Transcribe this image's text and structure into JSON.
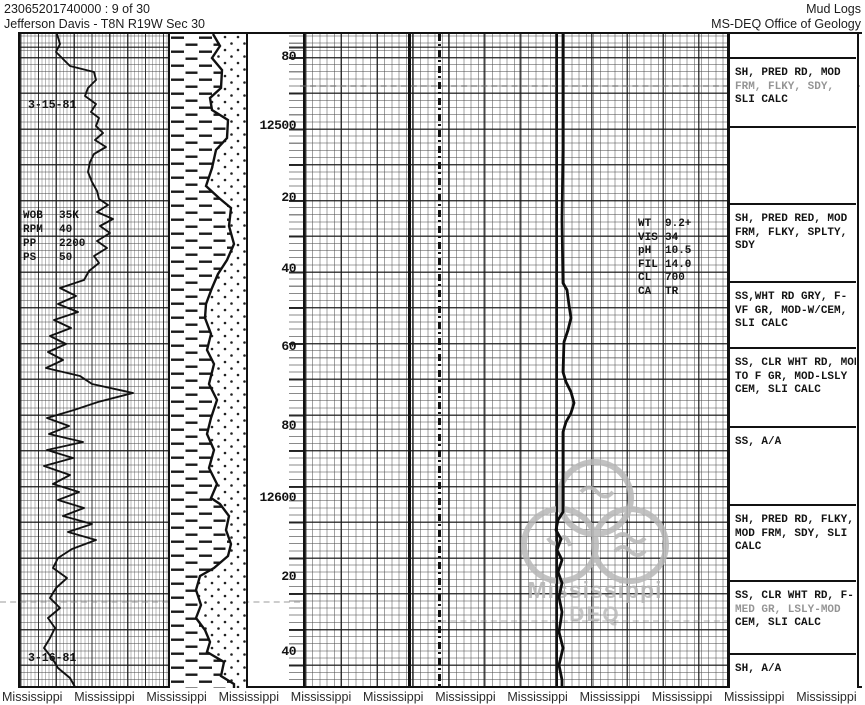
{
  "header": {
    "left_line1": "23065201740000 : 9 of 30",
    "left_line2": "Jefferson Davis - T8N R19W Sec 30",
    "right_line1": "Mud Logs",
    "right_line2": "MS-DEQ Office of Geology"
  },
  "log": {
    "dates": [
      {
        "text": "3-15-81"
      },
      {
        "text": "3-16-81"
      }
    ],
    "drill_params": {
      "rows": [
        [
          "WOB",
          "35K"
        ],
        [
          "RPM",
          "40"
        ],
        [
          "PP",
          "2200"
        ],
        [
          "PS",
          "50"
        ]
      ]
    },
    "mud_data": {
      "rows": [
        [
          "WT",
          "9.2+"
        ],
        [
          "VIS",
          "34"
        ],
        [
          "pH",
          "10.5"
        ],
        [
          "FIL",
          "14.0"
        ],
        [
          "CL",
          "700"
        ],
        [
          "CA",
          "TR"
        ]
      ]
    },
    "depth_labels": [
      {
        "text": "80",
        "y": 57
      },
      {
        "text": "12500",
        "y": 126
      },
      {
        "text": "20",
        "y": 198
      },
      {
        "text": "40",
        "y": 269
      },
      {
        "text": "60",
        "y": 347
      },
      {
        "text": "80",
        "y": 426
      },
      {
        "text": "12600",
        "y": 498
      },
      {
        "text": "20",
        "y": 577
      },
      {
        "text": "40",
        "y": 652
      }
    ],
    "desc_bottom": 688,
    "descriptions": [
      {
        "top": 34,
        "lines": []
      },
      {
        "top": 57,
        "lines": [
          "SH, PRED RD, MOD",
          "FRM, FLKY, SDY,",
          "SLI CALC"
        ],
        "faded_line": 1
      },
      {
        "top": 126,
        "lines": []
      },
      {
        "top": 203,
        "lines": [
          "SH, PRED RED, MOD",
          "FRM, FLKY, SPLTY,",
          "SDY"
        ]
      },
      {
        "top": 281,
        "lines": [
          "SS,WHT RD GRY, F-",
          "VF GR, MOD-W/CEM,",
          "SLI CALC"
        ]
      },
      {
        "top": 347,
        "lines": [
          "SS, CLR WHT RD, MOD",
          "TO F GR, MOD-LSLY",
          "CEM, SLI CALC"
        ]
      },
      {
        "top": 426,
        "lines": [
          "SS, A/A"
        ]
      },
      {
        "top": 504,
        "lines": [
          "SH, PRED RD, FLKY,",
          "MOD FRM, SDY, SLI",
          "CALC"
        ]
      },
      {
        "top": 580,
        "lines": [
          "SS, CLR WHT RD, F-",
          "MED GR, LSLY-MOD",
          "CEM, SLI CALC"
        ],
        "faded_line": 1
      },
      {
        "top": 653,
        "lines": [
          "SH, A/A"
        ]
      }
    ],
    "watermark": {
      "line1": "Mississippi",
      "line2": "DEQ",
      "color": "#b4b4b4"
    },
    "bottom_watermark": "Mississippi",
    "bottom_watermark_count": 12,
    "rop_curve": [
      [
        57,
        34
      ],
      [
        60,
        44
      ],
      [
        56,
        52
      ],
      [
        64,
        60
      ],
      [
        70,
        66
      ],
      [
        94,
        72
      ],
      [
        96,
        80
      ],
      [
        88,
        88
      ],
      [
        85,
        96
      ],
      [
        96,
        104
      ],
      [
        91,
        112
      ],
      [
        99,
        118
      ],
      [
        96,
        126
      ],
      [
        103,
        133
      ],
      [
        95,
        140
      ],
      [
        106,
        147
      ],
      [
        94,
        154
      ],
      [
        90,
        162
      ],
      [
        88,
        172
      ],
      [
        92,
        182
      ],
      [
        97,
        191
      ],
      [
        99,
        199
      ],
      [
        108,
        205
      ],
      [
        97,
        212
      ],
      [
        113,
        219
      ],
      [
        100,
        226
      ],
      [
        110,
        233
      ],
      [
        97,
        241
      ],
      [
        107,
        248
      ],
      [
        94,
        256
      ],
      [
        99,
        263
      ],
      [
        89,
        271
      ],
      [
        84,
        280
      ],
      [
        60,
        288
      ],
      [
        76,
        296
      ],
      [
        58,
        304
      ],
      [
        78,
        312
      ],
      [
        54,
        320
      ],
      [
        71,
        328
      ],
      [
        50,
        336
      ],
      [
        66,
        344
      ],
      [
        48,
        352
      ],
      [
        63,
        360
      ],
      [
        46,
        368
      ],
      [
        80,
        376
      ],
      [
        92,
        384
      ],
      [
        133,
        393
      ],
      [
        98,
        402
      ],
      [
        74,
        410
      ],
      [
        47,
        418
      ],
      [
        69,
        426
      ],
      [
        49,
        434
      ],
      [
        83,
        442
      ],
      [
        47,
        450
      ],
      [
        73,
        458
      ],
      [
        44,
        466
      ],
      [
        70,
        475
      ],
      [
        53,
        484
      ],
      [
        79,
        492
      ],
      [
        58,
        500
      ],
      [
        84,
        508
      ],
      [
        63,
        516
      ],
      [
        92,
        524
      ],
      [
        68,
        532
      ],
      [
        96,
        540
      ],
      [
        72,
        549
      ],
      [
        58,
        558
      ],
      [
        53,
        568
      ],
      [
        67,
        578
      ],
      [
        56,
        588
      ],
      [
        50,
        598
      ],
      [
        60,
        608
      ],
      [
        48,
        618
      ],
      [
        55,
        628
      ],
      [
        50,
        638
      ],
      [
        44,
        648
      ],
      [
        52,
        658
      ],
      [
        58,
        668
      ],
      [
        70,
        678
      ],
      [
        75,
        687
      ]
    ],
    "gas_curve": [
      [
        563,
        34
      ],
      [
        563,
        150
      ],
      [
        562,
        220
      ],
      [
        563,
        283
      ],
      [
        567,
        290
      ],
      [
        569,
        305
      ],
      [
        571,
        318
      ],
      [
        568,
        330
      ],
      [
        564,
        342
      ],
      [
        563,
        372
      ],
      [
        566,
        382
      ],
      [
        571,
        392
      ],
      [
        574,
        403
      ],
      [
        571,
        413
      ],
      [
        566,
        422
      ],
      [
        563,
        432
      ],
      [
        563,
        512
      ],
      [
        558,
        520
      ],
      [
        556,
        530
      ],
      [
        561,
        539
      ],
      [
        557,
        550
      ],
      [
        562,
        560
      ],
      [
        558,
        572
      ],
      [
        562,
        583
      ],
      [
        559,
        597
      ],
      [
        562,
        612
      ],
      [
        559,
        632
      ],
      [
        563,
        648
      ],
      [
        559,
        665
      ],
      [
        562,
        680
      ],
      [
        562,
        688
      ]
    ],
    "litho_boundary": [
      [
        213,
        34
      ],
      [
        220,
        46
      ],
      [
        212,
        58
      ],
      [
        222,
        70
      ],
      [
        221,
        88
      ],
      [
        210,
        98
      ],
      [
        212,
        110
      ],
      [
        228,
        120
      ],
      [
        227,
        138
      ],
      [
        216,
        150
      ],
      [
        212,
        168
      ],
      [
        206,
        186
      ],
      [
        219,
        198
      ],
      [
        231,
        208
      ],
      [
        229,
        226
      ],
      [
        234,
        244
      ],
      [
        227,
        260
      ],
      [
        218,
        274
      ],
      [
        212,
        288
      ],
      [
        206,
        304
      ],
      [
        205,
        318
      ],
      [
        211,
        334
      ],
      [
        207,
        350
      ],
      [
        214,
        364
      ],
      [
        209,
        384
      ],
      [
        217,
        400
      ],
      [
        211,
        418
      ],
      [
        207,
        434
      ],
      [
        214,
        450
      ],
      [
        209,
        468
      ],
      [
        217,
        484
      ],
      [
        211,
        498
      ],
      [
        220,
        504
      ],
      [
        229,
        516
      ],
      [
        226,
        530
      ],
      [
        231,
        544
      ],
      [
        228,
        556
      ],
      [
        214,
        568
      ],
      [
        200,
        576
      ],
      [
        196,
        590
      ],
      [
        201,
        605
      ],
      [
        196,
        618
      ],
      [
        205,
        630
      ],
      [
        210,
        642
      ],
      [
        207,
        652
      ],
      [
        224,
        662
      ],
      [
        221,
        676
      ],
      [
        234,
        684
      ],
      [
        234,
        688
      ]
    ]
  }
}
